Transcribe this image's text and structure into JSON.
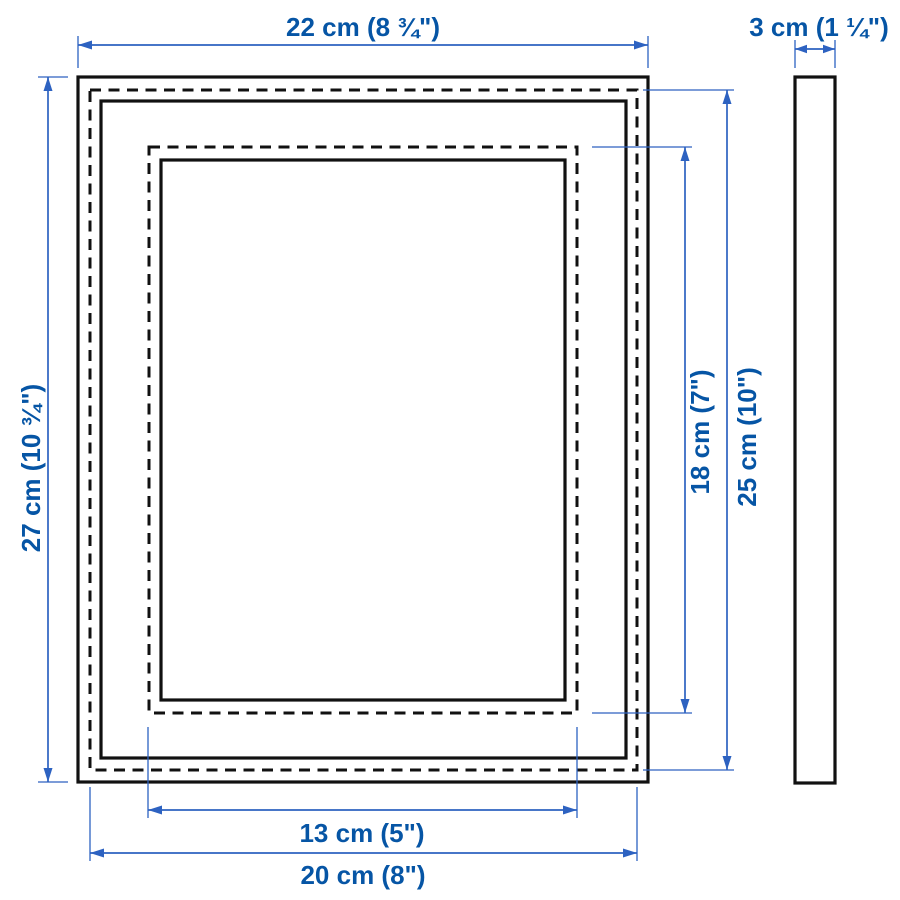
{
  "diagram": {
    "subject": "picture frame dimension drawing",
    "views": {
      "front": "front-view",
      "side": "side-profile-view"
    },
    "dimensions": {
      "outer_width": "22 cm (8 ¾\")",
      "outer_height": "27 cm (10 ¾\")",
      "opening_height_with_mat": "18 cm (7\")",
      "picture_height_without_mat": "25 cm (10\")",
      "opening_width_with_mat": "13 cm (5\")",
      "picture_width_without_mat": "20 cm (8\")",
      "depth": "3 cm (1 ¼\")"
    },
    "colors": {
      "background": "#ffffff",
      "outline": "#111111",
      "dimension_line": "#2d62c1",
      "dimension_text": "#0655a5"
    }
  }
}
